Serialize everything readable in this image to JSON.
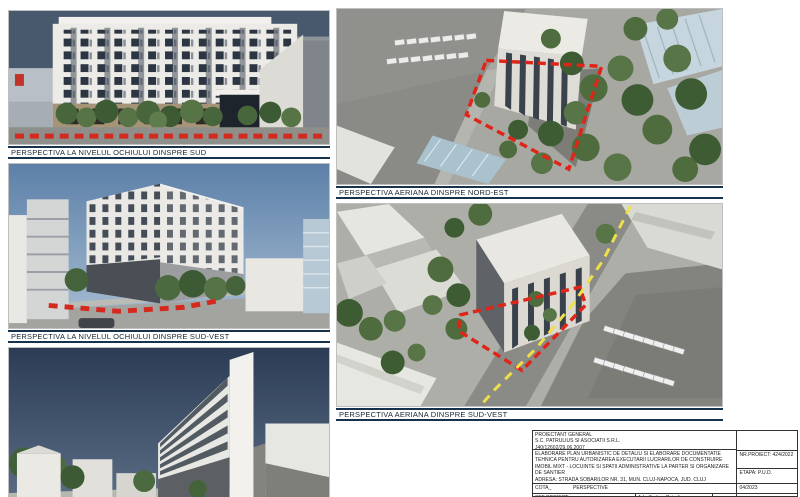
{
  "captions": {
    "eye_level_south": "PERSPECTIVA LA NIVELUL OCHIULUI DINSPRE SUD",
    "eye_level_southwest": "PERSPECTIVA LA NIVELUL OCHIULUI DINSPRE SUD-VEST",
    "aerial_northeast": "PERSPECTIVA AERIANA DINSPRE NORD-EST",
    "aerial_southwest": "PERSPECTIVA AERIANA DINSPRE SUD-VEST"
  },
  "title_block": {
    "designer_label": "PROIECTANT GENERAL",
    "designer_name": "S.C. PATRULIUS SI ASOCIATII S.R.L.",
    "designer_reg_no": "J40/12602/29.06.2007",
    "project_title": "ELABORARE PLAN URBANISTIC DE DETALIU SI ELABORARE DOCUMENTATIE TEHNICA PENTRU AUTORIZAREA EXECUTARII LUCRARILOR DE CONSTRUIRE IMOBIL MIXT - LOCUINTE SI SPATII ADMINISTRATIVE LA PARTER SI ORGANIZARE DE SANTIER",
    "address": "ADRESA: STRADA SOBARILOR NR. 31, MUN. CLUJ-NAPOCA, JUD. CLUJ",
    "beneficiary": "BENEFICIAR: PRIMARIA MUNICIPIULUI CLUJ-NAPOCA",
    "project_no": "NR.PROIECT: 424/2022",
    "stage": "ETAPA: P.U.D.",
    "cota_label": "COTA_",
    "sheet_title": "PERSPECTIVE",
    "date": "04/2023",
    "chief_architect_label": "SEF PROIECT",
    "chief_architect_name": "Arh. Serban Patrulius"
  },
  "colors": {
    "boundary_red": "#d42a1e",
    "road_marking_yellow": "#efe04a",
    "caption_border_navy": "#16324c",
    "sky_dark": "#49596d",
    "sky_day": "#6286ad"
  }
}
